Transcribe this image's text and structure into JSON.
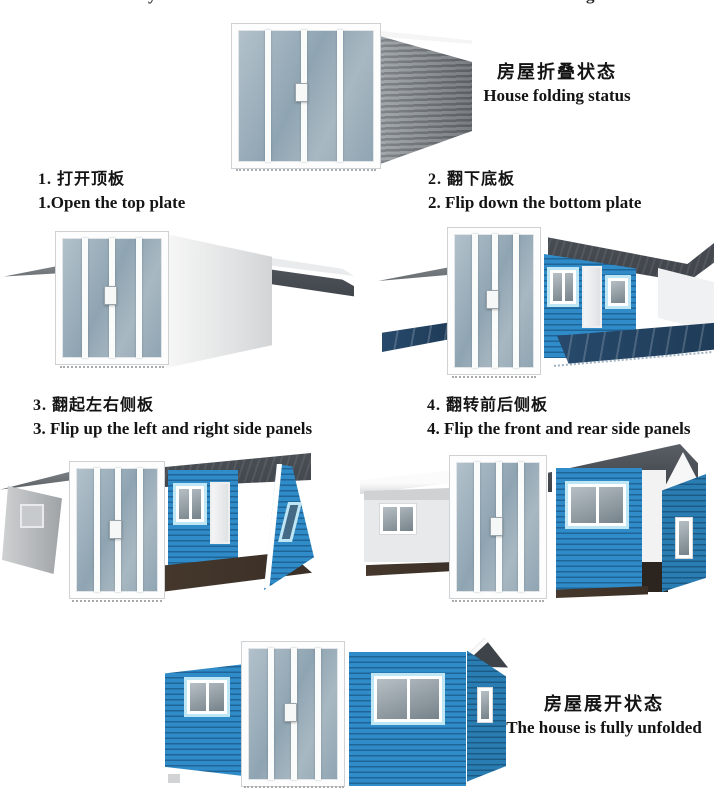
{
  "colors": {
    "siding-blue": "#2f8cc9",
    "siding-shadow": "#1f6598",
    "trim-blue": "#bfe6f5",
    "roof-dark": "#4a4f55",
    "roof-darker": "#3e4349",
    "floor-navy": "#1f3c58",
    "floor-brown": "#3b3027",
    "wall-gray": "#9aa0a5",
    "wall-gray-dark": "#74797e",
    "glass-light": "#b3c2cc",
    "glass-dark": "#8fa4b2",
    "frame-white": "#fdfdfd"
  },
  "top_fragments": {
    "left": "y",
    "right": "g"
  },
  "captions": {
    "folded": {
      "zh": "房屋折叠状态",
      "en": "House folding status"
    },
    "unfolded": {
      "zh": "房屋展开状态",
      "en": "The house is fully unfolded"
    }
  },
  "steps": [
    {
      "zh": "1. 打开顶板",
      "en": "1.Open the top plate"
    },
    {
      "zh": "2. 翻下底板",
      "en": "2. Flip down the bottom plate"
    },
    {
      "zh": "3. 翻起左右侧板",
      "en": "3. Flip up the left and right side panels"
    },
    {
      "zh": "4. 翻转前后侧板",
      "en": "4. Flip the front and rear side panels"
    }
  ]
}
